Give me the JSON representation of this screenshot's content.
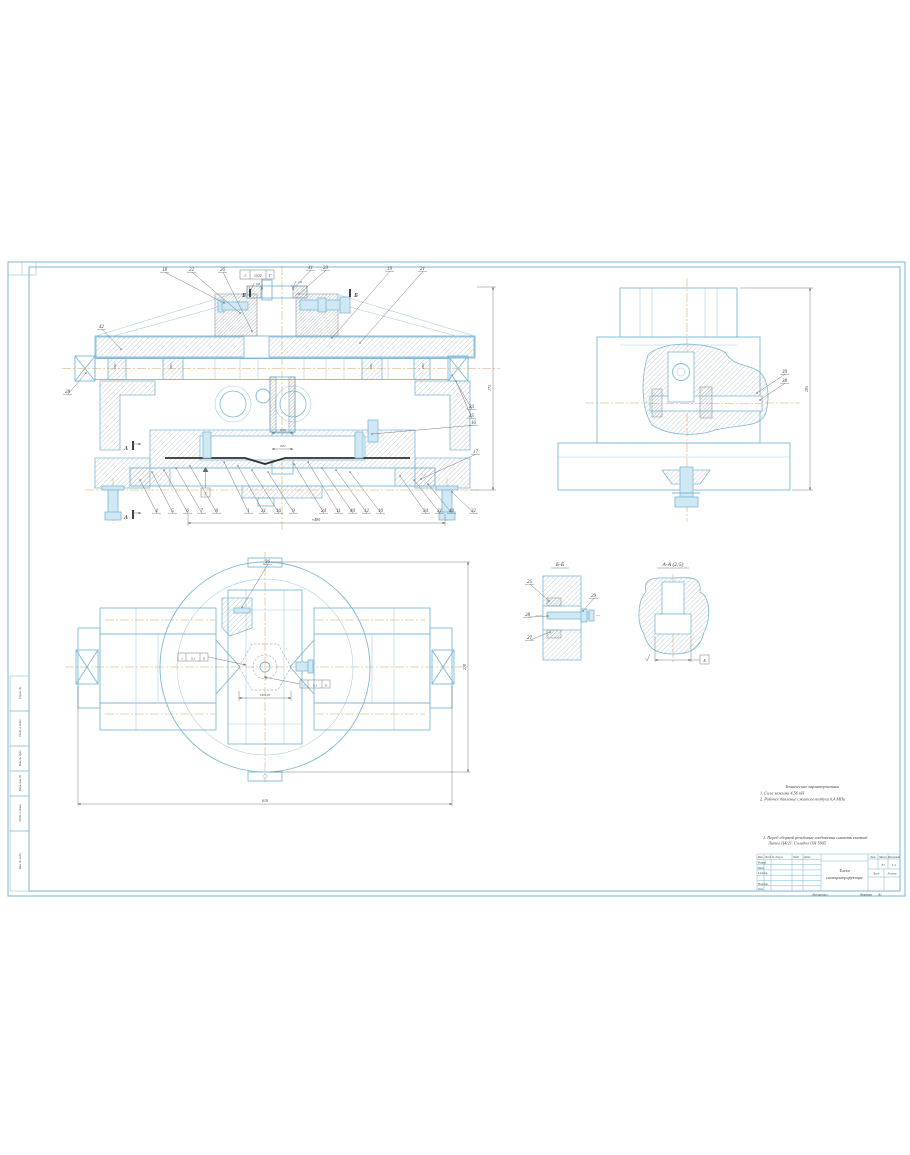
{
  "sheet": {
    "copied_label": "Копировал",
    "format_label": "Формат",
    "format_value": "А1"
  },
  "strips": [
    "Справ. №",
    "Подп. и дата",
    "Инв. № дубл.",
    "Взам. инв. №",
    "Подп. и дата",
    "Инв. № подл."
  ],
  "tech_req": {
    "title": "Технические характеристики",
    "items": [
      "1. Сила зажима 4,56 кН",
      "2. Рабочее давление сжатого воздуха 0,4 МПа"
    ]
  },
  "notes": [
    "1. Перед сборкой резьбовые соединения смазать смазкой",
    "Литол Ц4/21. Солидол ОН 5905"
  ],
  "title_block": {
    "header_cols": [
      "Изм.",
      "Лист",
      "№ докум.",
      "Подп.",
      "Дата"
    ],
    "row_labels": [
      "Разраб.",
      "Пров.",
      "Т.контр.",
      "Н.контр.",
      "Утв."
    ],
    "doc_title_line1": "Тиски",
    "doc_title_line2": "самоцентрирующие",
    "lit_label": "Лит.",
    "mass_label": "Масса",
    "scale_label": "Масштаб",
    "mass_value": "37",
    "scale_value": "1:1",
    "sheet_label": "Лист",
    "sheets_label": "Листов"
  },
  "views": {
    "main": {
      "tol_symbol": "//",
      "tol_value": "0,02",
      "tol_datum": "Г",
      "datum_flag": "Г",
      "section_a": "А",
      "section_b": "Б",
      "roughness": [
        "0,8",
        "1,6"
      ],
      "shaft_dims": [
        "Ø20",
        "Ø25",
        "Ø25",
        "Ø20"
      ],
      "center_dims": [
        "Ø40",
        "Ø32"
      ],
      "dim_right": "175",
      "dim_bottom": "≈480"
    },
    "side": {
      "dim_right": "205"
    },
    "plan": {
      "tol_symbol": "//",
      "tol_value": "0,1",
      "tol_datum": "Б",
      "dim_across": "24±0,05",
      "dim_width": "610",
      "dim_height": "210"
    },
    "section_bb": {
      "label": "Б-Б"
    },
    "view_aa": {
      "label": "А-А (2:5)",
      "datum": "Б"
    }
  },
  "callouts": {
    "main_top": [
      {
        "n": "18",
        "x": 163,
        "y": 271,
        "tx": 224,
        "ty": 303
      },
      {
        "n": "22",
        "x": 190,
        "y": 271,
        "tx": 240,
        "ty": 313
      },
      {
        "n": "26",
        "x": 221,
        "y": 271,
        "tx": 252,
        "ty": 331
      },
      {
        "n": "41",
        "x": 309,
        "y": 269,
        "tx": 293,
        "ty": 289
      },
      {
        "n": "23",
        "x": 324,
        "y": 269,
        "tx": 299,
        "ty": 294
      },
      {
        "n": "19",
        "x": 388,
        "y": 270,
        "tx": 332,
        "ty": 338
      },
      {
        "n": "21",
        "x": 421,
        "y": 270,
        "tx": 360,
        "ty": 343
      }
    ],
    "main_left": [
      {
        "n": "28",
        "x": 66,
        "y": 393,
        "tx": 86,
        "ty": 373
      },
      {
        "n": "42",
        "x": 100,
        "y": 328,
        "tx": 121,
        "ty": 349
      }
    ],
    "main_right": [
      {
        "n": "33",
        "x": 470,
        "y": 408,
        "tx": 452,
        "ty": 375
      },
      {
        "n": "35",
        "x": 470,
        "y": 417,
        "tx": 456,
        "ty": 381
      },
      {
        "n": "16",
        "x": 472,
        "y": 424,
        "tx": 372,
        "ty": 434
      },
      {
        "n": "17",
        "x": 474,
        "y": 453,
        "tx": 421,
        "ty": 479
      }
    ],
    "main_bottom": [
      {
        "n": "4",
        "x": 155,
        "y": 512,
        "tx": 140,
        "ty": 480
      },
      {
        "n": "5",
        "x": 171,
        "y": 512,
        "tx": 152,
        "ty": 472
      },
      {
        "n": "6",
        "x": 186,
        "y": 512,
        "tx": 164,
        "ty": 470
      },
      {
        "n": "7",
        "x": 200,
        "y": 512,
        "tx": 176,
        "ty": 468
      },
      {
        "n": "8",
        "x": 215,
        "y": 512,
        "tx": 190,
        "ty": 466
      },
      {
        "n": "1",
        "x": 247,
        "y": 512,
        "tx": 224,
        "ty": 462
      },
      {
        "n": "31",
        "x": 262,
        "y": 512,
        "tx": 238,
        "ty": 466
      },
      {
        "n": "16",
        "x": 277,
        "y": 512,
        "tx": 252,
        "ty": 470
      },
      {
        "n": "9",
        "x": 292,
        "y": 512,
        "tx": 268,
        "ty": 472
      },
      {
        "n": "24",
        "x": 322,
        "y": 512,
        "tx": 294,
        "ty": 464
      },
      {
        "n": "11",
        "x": 337,
        "y": 512,
        "tx": 308,
        "ty": 462
      },
      {
        "n": "40",
        "x": 351,
        "y": 512,
        "tx": 322,
        "ty": 468
      },
      {
        "n": "12",
        "x": 365,
        "y": 512,
        "tx": 336,
        "ty": 470
      },
      {
        "n": "10",
        "x": 379,
        "y": 512,
        "tx": 350,
        "ty": 472
      },
      {
        "n": "34",
        "x": 424,
        "y": 512,
        "tx": 400,
        "ty": 476
      },
      {
        "n": "31",
        "x": 438,
        "y": 512,
        "tx": 414,
        "ty": 480
      },
      {
        "n": "40",
        "x": 450,
        "y": 512,
        "tx": 428,
        "ty": 484
      },
      {
        "n": "32",
        "x": 472,
        "y": 512,
        "tx": 452,
        "ty": 492
      }
    ],
    "side": [
      {
        "n": "39",
        "x": 783,
        "y": 373,
        "tx": 757,
        "ty": 393
      },
      {
        "n": "38",
        "x": 783,
        "y": 382,
        "tx": 760,
        "ty": 400
      }
    ],
    "plan": [
      {
        "n": "36",
        "x": 266,
        "y": 563,
        "tx": 242,
        "ty": 607
      }
    ],
    "bb": [
      {
        "n": "25",
        "x": 528,
        "y": 583,
        "tx": 549,
        "ty": 601
      },
      {
        "n": "29",
        "x": 592,
        "y": 597,
        "tx": 583,
        "ty": 611
      },
      {
        "n": "28",
        "x": 526,
        "y": 616,
        "tx": 548,
        "ty": 616
      },
      {
        "n": "27",
        "x": 528,
        "y": 639,
        "tx": 550,
        "ty": 632
      }
    ]
  }
}
